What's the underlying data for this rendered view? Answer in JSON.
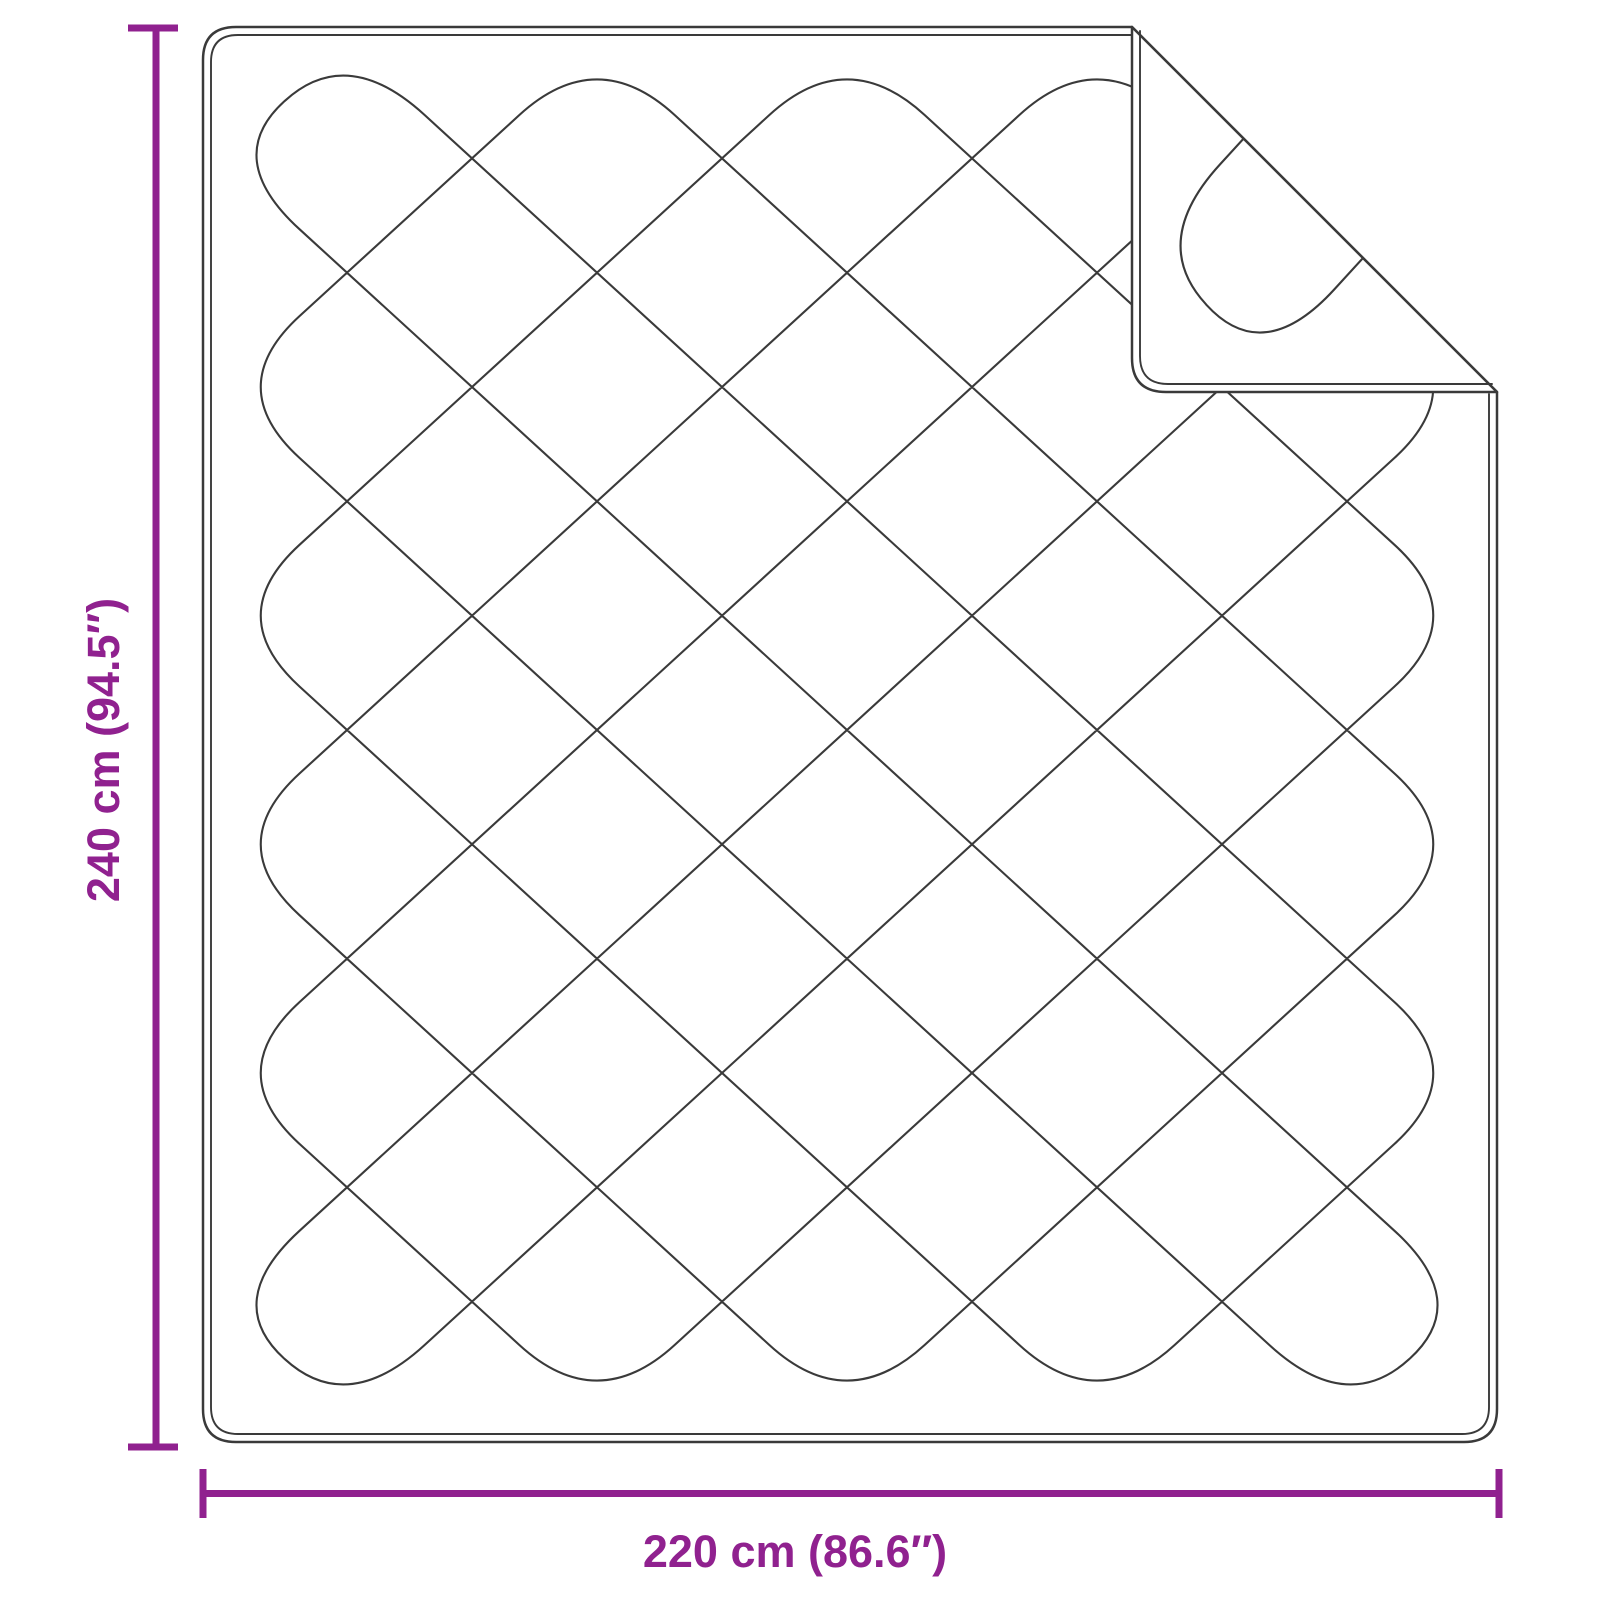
{
  "diagram": {
    "kind": "quilted-blanket-dimension-diagram",
    "vertical_dimension": {
      "label": "240 cm (94.5″)"
    },
    "horizontal_dimension": {
      "label": "220 cm (86.6″)"
    },
    "colors": {
      "dimension_accent": "#90218f",
      "outline_ink": "#3a3a3a",
      "background": "#ffffff"
    }
  }
}
